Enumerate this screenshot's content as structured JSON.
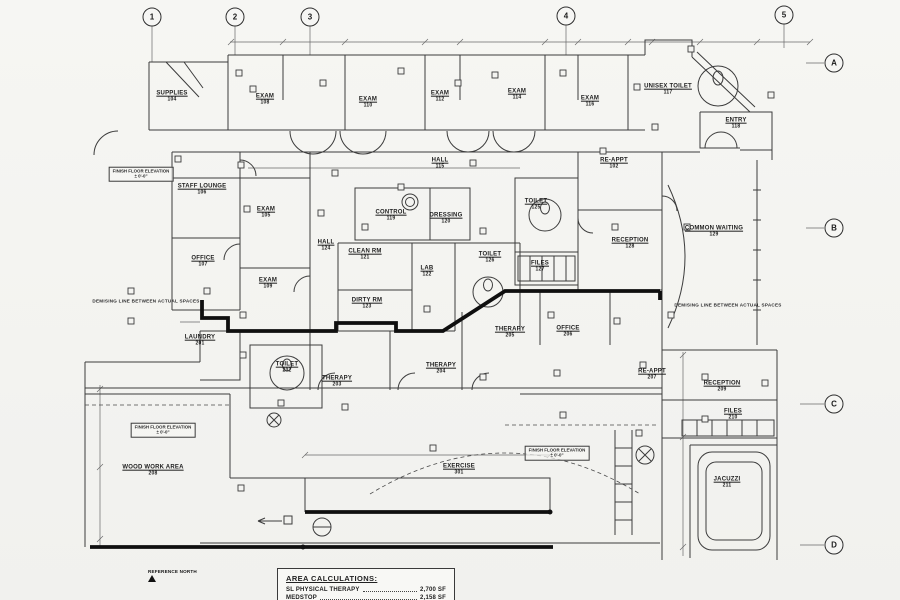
{
  "drawing": {
    "kind": "floor-plan",
    "grid_markers": [
      {
        "label": "1",
        "x": 152,
        "y": 17
      },
      {
        "label": "2",
        "x": 235,
        "y": 17
      },
      {
        "label": "3",
        "x": 310,
        "y": 17
      },
      {
        "label": "4",
        "x": 566,
        "y": 16
      },
      {
        "label": "5",
        "x": 784,
        "y": 15
      },
      {
        "label": "A",
        "x": 834,
        "y": 63
      },
      {
        "label": "B",
        "x": 834,
        "y": 228
      },
      {
        "label": "C",
        "x": 834,
        "y": 404
      },
      {
        "label": "D",
        "x": 834,
        "y": 545
      }
    ],
    "rooms": [
      {
        "name": "SUPPLIES",
        "number": "104",
        "x": 172,
        "y": 97
      },
      {
        "name": "EXAM",
        "number": "108",
        "x": 265,
        "y": 100
      },
      {
        "name": "EXAM",
        "number": "110",
        "x": 368,
        "y": 103
      },
      {
        "name": "EXAM",
        "number": "112",
        "x": 440,
        "y": 97
      },
      {
        "name": "EXAM",
        "number": "114",
        "x": 517,
        "y": 95
      },
      {
        "name": "EXAM",
        "number": "116",
        "x": 590,
        "y": 102
      },
      {
        "name": "UNISEX TOILET",
        "number": "117",
        "x": 668,
        "y": 90
      },
      {
        "name": "ENTRY",
        "number": "118",
        "x": 736,
        "y": 124
      },
      {
        "name": "HALL",
        "number": "115",
        "x": 440,
        "y": 164
      },
      {
        "name": "RE-APPT",
        "number": "102",
        "x": 614,
        "y": 164
      },
      {
        "name": "STAFF LOUNGE",
        "number": "106",
        "x": 202,
        "y": 190
      },
      {
        "name": "EXAM",
        "number": "105",
        "x": 266,
        "y": 213
      },
      {
        "name": "CONTROL",
        "number": "119",
        "x": 391,
        "y": 216
      },
      {
        "name": "DRESSING",
        "number": "120",
        "x": 446,
        "y": 219
      },
      {
        "name": "TOILET",
        "number": "125",
        "x": 536,
        "y": 205
      },
      {
        "name": "OFFICE",
        "number": "107",
        "x": 203,
        "y": 262
      },
      {
        "name": "HALL",
        "number": "124",
        "x": 326,
        "y": 246
      },
      {
        "name": "CLEAN RM",
        "number": "121",
        "x": 365,
        "y": 255
      },
      {
        "name": "LAB",
        "number": "122",
        "x": 427,
        "y": 272
      },
      {
        "name": "TOILET",
        "number": "126",
        "x": 490,
        "y": 258
      },
      {
        "name": "FILES",
        "number": "127",
        "x": 540,
        "y": 267
      },
      {
        "name": "RECEPTION",
        "number": "128",
        "x": 630,
        "y": 244
      },
      {
        "name": "COMMON WAITING",
        "number": "129",
        "x": 714,
        "y": 232
      },
      {
        "name": "EXAM",
        "number": "109",
        "x": 268,
        "y": 284
      },
      {
        "name": "DIRTY RM",
        "number": "123",
        "x": 367,
        "y": 304
      },
      {
        "name": "LAUNDRY",
        "number": "201",
        "x": 200,
        "y": 341
      },
      {
        "name": "TOILET",
        "number": "202",
        "x": 287,
        "y": 368
      },
      {
        "name": "THERAPY",
        "number": "203",
        "x": 337,
        "y": 382
      },
      {
        "name": "THERAPY",
        "number": "204",
        "x": 441,
        "y": 369
      },
      {
        "name": "THERAPY",
        "number": "205",
        "x": 510,
        "y": 333
      },
      {
        "name": "OFFICE",
        "number": "206",
        "x": 568,
        "y": 332
      },
      {
        "name": "RE-APPT",
        "number": "207",
        "x": 652,
        "y": 375
      },
      {
        "name": "RECEPTION",
        "number": "209",
        "x": 722,
        "y": 387
      },
      {
        "name": "FILES",
        "number": "210",
        "x": 733,
        "y": 415
      },
      {
        "name": "JACUZZI",
        "number": "211",
        "x": 727,
        "y": 483
      },
      {
        "name": "WOOD WORK AREA",
        "number": "208",
        "x": 153,
        "y": 471
      },
      {
        "name": "EXERCISE",
        "number": "301",
        "x": 459,
        "y": 470
      }
    ],
    "notes": [
      {
        "text": "DEMISING LINE BETWEEN ACTUAL SPACES",
        "x": 146,
        "y": 301
      },
      {
        "text": "DEMISING LINE BETWEEN ACTUAL SPACES",
        "x": 728,
        "y": 305
      }
    ],
    "elevation_boxes": [
      {
        "line1": "FINISH FLOOR ELEVATION",
        "line2": "± 0'-0\"",
        "x": 141,
        "y": 174
      },
      {
        "line1": "FINISH FLOOR ELEVATION",
        "line2": "± 0'-0\"",
        "x": 163,
        "y": 430
      },
      {
        "line1": "FINISH FLOOR ELEVATION",
        "line2": "± 0'-0\"",
        "x": 557,
        "y": 453
      }
    ]
  },
  "area_calculations": {
    "title": "AREA CALCULATIONS:",
    "rows": [
      {
        "label": "SL PHYSICAL THERAPY",
        "value": "2,700 SF"
      },
      {
        "label": "MEDSTOP",
        "value": "2,158 SF"
      }
    ]
  },
  "reference_north": {
    "label": "REFERENCE NORTH"
  }
}
